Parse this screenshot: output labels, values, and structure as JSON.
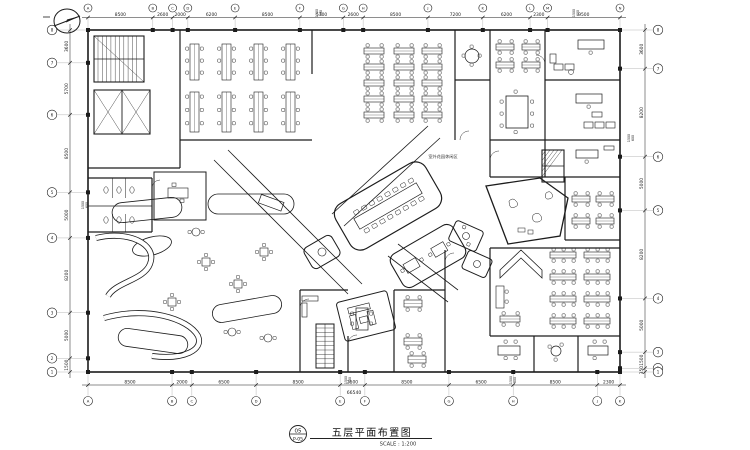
{
  "page": {
    "background": "#ffffff",
    "line_color": "#1c1c1c"
  },
  "grid": {
    "top_labels": [
      "A",
      "B",
      "C",
      "D",
      "E",
      "F",
      "G",
      "H",
      "J",
      "K",
      "L",
      "M",
      "N"
    ],
    "bottom_labels": [
      "A",
      "B",
      "C",
      "D",
      "E",
      "F",
      "G",
      "H",
      "J",
      "K"
    ],
    "left_labels": [
      "8",
      "7",
      "6",
      "5",
      "4",
      "3",
      "2",
      "1"
    ],
    "right_labels": [
      "8",
      "7",
      "6",
      "5",
      "4",
      "3",
      "2",
      "1"
    ]
  },
  "dimensions": {
    "top": [
      "8500",
      "2600",
      "2000",
      "6200",
      "8500",
      "5700",
      "2600",
      "8500",
      "7200",
      "6200",
      "2300",
      "9500"
    ],
    "bottom": [
      "8500",
      "2000",
      "6500",
      "8500",
      "2500",
      "8500",
      "6500",
      "8500",
      "2300"
    ],
    "left": [
      "3600",
      "5700",
      "8500",
      "5000",
      "8200",
      "5000",
      "1500"
    ],
    "right": [
      "3600",
      "8200",
      "5000",
      "8200",
      "5000",
      "1500",
      "350"
    ],
    "bottom_total": "66540",
    "sub_dims": [
      "1500",
      "600"
    ]
  },
  "plan_labels": {
    "terrace": "室外花园休闲区"
  },
  "title_block": {
    "sheet_number": "05",
    "sheet_code": "P-05",
    "title": "五层平面布置图",
    "scale": "SCALE : 1:200"
  }
}
